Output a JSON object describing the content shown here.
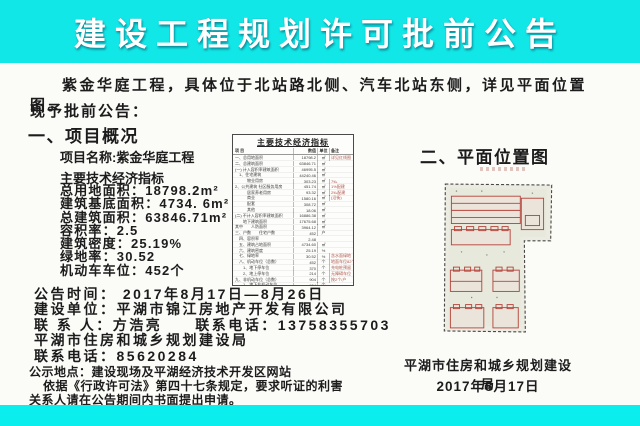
{
  "colors": {
    "banner_cyan": "#12e7e7",
    "bottom_band_cyan": "#0beeee",
    "map_outline_red": "#b5443b",
    "text_dark": "#1c1c1c"
  },
  "banner": {
    "title": "建设工程规划许可批前公告"
  },
  "intro": {
    "paragraph": "紫金华庭工程，具体位于北站路北侧、汽车北站东侧，详见平面位置图。",
    "announce": "现予批前公告："
  },
  "section1": {
    "heading": "一、项目概况",
    "project_name": "项目名称:紫金华庭工程",
    "indicators_title": "主要技术经济指标",
    "indicators": [
      {
        "text": "总用地面积：18798.2m²"
      },
      {
        "text": "建筑基底面积：4734. 6m²"
      },
      {
        "text": "总建筑面积：63846.71m²"
      },
      {
        "text": "容积率：2.5"
      },
      {
        "text": "建筑密度：25.19%"
      },
      {
        "text": "绿地率：30.52"
      },
      {
        "text": "机动车车位：452个"
      }
    ]
  },
  "table": {
    "title": "主要技术经济指标",
    "headers": {
      "item": "项  目",
      "value": "数值",
      "unit": "单位",
      "note": "备注"
    },
    "rows": [
      {
        "label": "一、总用地面积",
        "value": "18798.2",
        "unit": "㎡",
        "note": "详见红线图"
      },
      {
        "label": "二、总建筑面积",
        "value": "63846.71",
        "unit": "㎡",
        "note": ""
      },
      {
        "label": "(一) 计入容积率建筑面积",
        "value": "46995.5",
        "unit": "㎡",
        "note": ""
      },
      {
        "label": "　1、住宅建筑",
        "value": "44240.46",
        "unit": "㎡",
        "note": ""
      },
      {
        "label": "　　　物业用房",
        "value": "303.23",
        "unit": "㎡",
        "note": "7‰"
      },
      {
        "label": "2、公共建筑  社区服务用房",
        "value": "451.74",
        "unit": "㎡",
        "note": "1%配建"
      },
      {
        "label": "　　　居家养老用房",
        "value": "93.32",
        "unit": "㎡",
        "note": "2‰配建"
      },
      {
        "label": "　　　商业",
        "value": "1580.16",
        "unit": "㎡",
        "note": "(沿街)"
      },
      {
        "label": "　　　配套",
        "value": "308.72",
        "unit": "㎡",
        "note": ""
      },
      {
        "label": "　　　其他",
        "value": "18.06",
        "unit": "㎡",
        "note": ""
      },
      {
        "label": "(二) 不计入容积率建筑面积",
        "value": "16886.38",
        "unit": "㎡",
        "note": ""
      },
      {
        "label": "　　地下建筑面积",
        "value": "17675.68",
        "unit": "㎡",
        "note": ""
      },
      {
        "label": "其中　　人防面积",
        "value": "3964.12",
        "unit": "㎡",
        "note": ""
      },
      {
        "label": "三、户数　　住宅户数",
        "value": "452",
        "unit": "户",
        "note": ""
      },
      {
        "label": "　四、容积率",
        "value": "2.48",
        "unit": "",
        "note": ""
      },
      {
        "label": "　五、建筑占地面积",
        "value": "4734.60",
        "unit": "㎡",
        "note": ""
      },
      {
        "label": "　六、建筑密度",
        "value": "25.19",
        "unit": "%",
        "note": ""
      },
      {
        "label": "　七、绿地率",
        "value": "30.52",
        "unit": "%",
        "note": "含水面绿地"
      },
      {
        "label": "　八、机动车位（总数）",
        "value": "452",
        "unit": "个",
        "note": "地面车位82个"
      },
      {
        "label": "　　1、地下停车位",
        "value": "370",
        "unit": "个",
        "note": "充电桩预留"
      },
      {
        "label": "　　2、地上停车位",
        "value": "214",
        "unit": "个",
        "note": "无障碍车位"
      },
      {
        "label": "九、非机动车位（总数）",
        "value": "904",
        "unit": "个",
        "note": "按2个/户"
      },
      {
        "label": "　　1、地下非机动车位",
        "value": "904",
        "unit": "个",
        "note": ""
      }
    ]
  },
  "details": {
    "lines": [
      {
        "text": "公告时间：  2017年8月17日—8月26日"
      },
      {
        "text": "建设单位：平湖市锦江房地产开发有限公司"
      },
      {
        "text": "联 系 人：方浩亮　　联系电话：13758355703"
      },
      {
        "text": "平湖市住房和城乡规划建设局"
      },
      {
        "text": "联系电话：85620284"
      }
    ]
  },
  "notice": {
    "location_line": "公示地点：建设现场及平湖经济技术开发区网站",
    "line1": "依据《行政许可法》第四十七条规定，要求听证的利害",
    "line2": "关系人请在公告期间内书面提出申请。"
  },
  "section2": {
    "heading": "二、平面位置图",
    "org": "平湖市住房和城乡规划建设局",
    "date": "2017年8月17日"
  }
}
